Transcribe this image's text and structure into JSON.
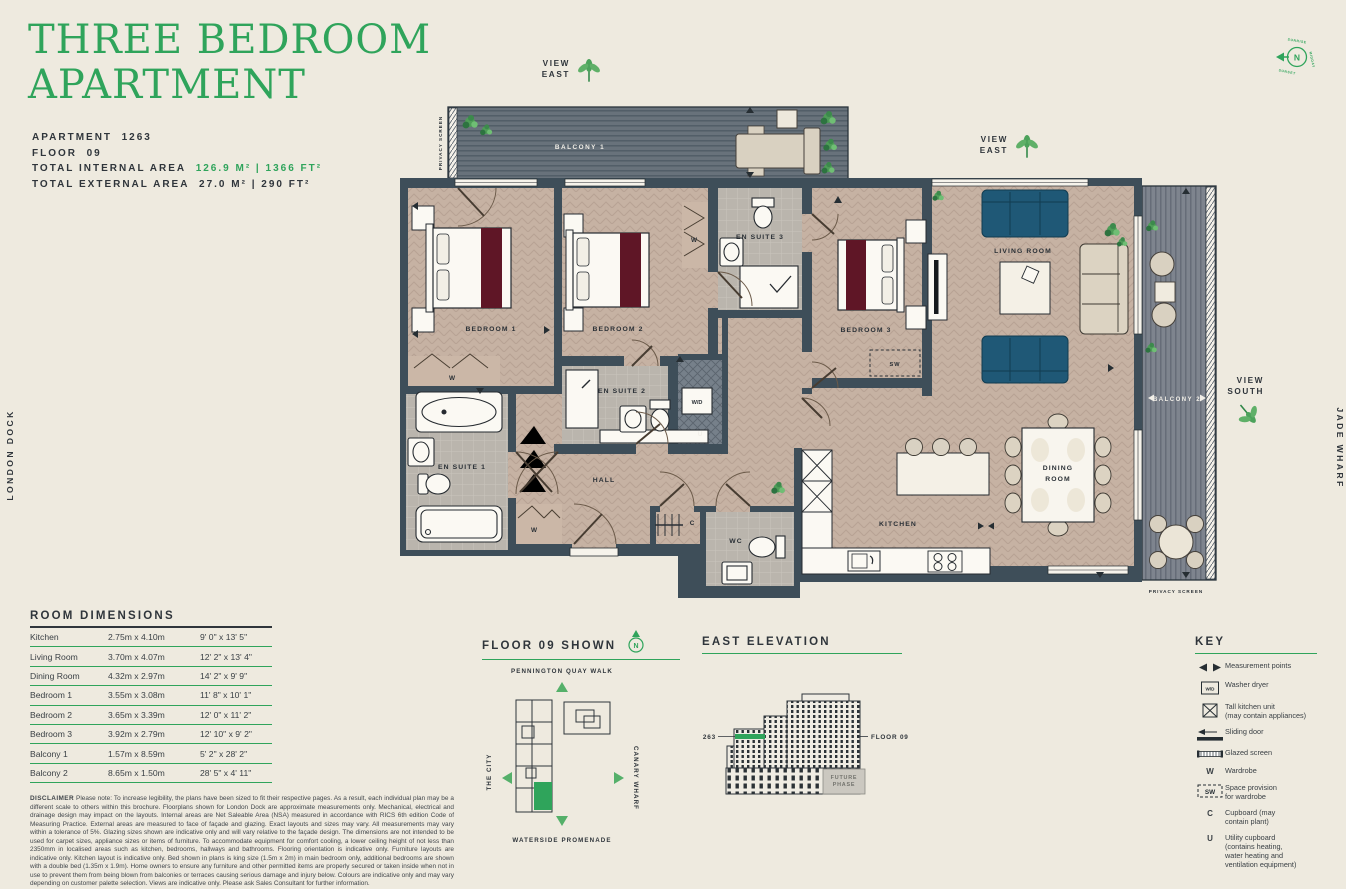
{
  "header": {
    "title_line1": "THREE BEDROOM",
    "title_line2": "APARTMENT",
    "apartment_label": "APARTMENT",
    "apartment_value": "1263",
    "floor_label": "FLOOR",
    "floor_value": "09",
    "internal_label": "TOTAL INTERNAL AREA",
    "internal_value": "126.9 M² | 1366 FT²",
    "external_label": "TOTAL EXTERNAL AREA",
    "external_value": "27.0 M² | 290 FT²"
  },
  "plan": {
    "balcony1": "BALCONY 1",
    "balcony2": "BALCONY 2",
    "privacy_screen": "PRIVACY SCREEN",
    "rooms": {
      "bedroom1": "BEDROOM 1",
      "bedroom2": "BEDROOM 2",
      "bedroom3": "BEDROOM 3",
      "ensuite1": "EN SUITE 1",
      "ensuite2": "EN SUITE 2",
      "ensuite3": "EN SUITE 3",
      "hall": "HALL",
      "wc": "WC",
      "kitchen": "KITCHEN",
      "dining": [
        "DINING",
        "ROOM"
      ],
      "living": "LIVING ROOM"
    },
    "markers": {
      "wardrobe": "W",
      "space_wardrobe": "SW",
      "washer_dryer": "W/D",
      "utility": "U",
      "cupboard": "C"
    },
    "view_east": [
      "VIEW",
      "EAST"
    ],
    "view_south": [
      "VIEW",
      "SOUTH"
    ],
    "compass": {
      "north": "N",
      "sunrise": "SUNRISE",
      "midday": "MIDDAY",
      "sunset": "SUNSET"
    },
    "london_dock": "LONDON DOCK",
    "jade_wharf": "JADE WHARF"
  },
  "dimensions": {
    "heading": "ROOM DIMENSIONS",
    "rows": [
      {
        "room": "Kitchen",
        "metric": "2.75m x 4.10m",
        "imperial": "9' 0\" x 13' 5\""
      },
      {
        "room": "Living Room",
        "metric": "3.70m x 4.07m",
        "imperial": "12' 2\" x 13' 4\""
      },
      {
        "room": "Dining Room",
        "metric": "4.32m x 2.97m",
        "imperial": "14' 2\" x 9' 9\""
      },
      {
        "room": "Bedroom 1",
        "metric": "3.55m x 3.08m",
        "imperial": "11' 8\" x 10' 1\""
      },
      {
        "room": "Bedroom 2",
        "metric": "3.65m x 3.39m",
        "imperial": "12' 0\" x 11' 2\""
      },
      {
        "room": "Bedroom 3",
        "metric": "3.92m x 2.79m",
        "imperial": "12' 10\" x 9' 2\""
      },
      {
        "room": "Balcony 1",
        "metric": "1.57m x 8.59m",
        "imperial": "5' 2\" x 28' 2\""
      },
      {
        "room": "Balcony 2",
        "metric": "8.65m x 1.50m",
        "imperial": "28' 5\" x 4' 11\""
      }
    ]
  },
  "disclaimer": {
    "label": "DISCLAIMER",
    "body": "Please note: To increase legibility, the plans have been sized to fit their respective pages. As a result, each individual plan may be a different scale to others within this brochure. Floorplans shown for London Dock are approximate measurements only. Mechanical, electrical and drainage design may impact on the layouts. Internal areas are Net Saleable Area (NSA) measured in accordance with RICS 6th edition Code of Measuring Practice. External areas are measured to face of façade and glazing. Exact layouts and sizes may vary. All measurements may vary within a tolerance of 5%. Glazing sizes shown are indicative only and will vary relative to the façade design. The dimensions are not intended to be used for carpet sizes, appliance sizes or items of furniture. To accommodate equipment for comfort cooling, a lower ceiling height of not less than 2350mm in localised areas such as kitchen, bedrooms, hallways and bathrooms. Flooring orientation is indicative only. Furniture layouts are indicative only. Kitchen layout is indicative only. Bed shown in plans is king size (1.5m x 2m) in main bedroom only, additional bedrooms are shown with a double bed (1.35m x 1.9m). Home owners to ensure any furniture and other permitted items are properly secured or taken inside when not in use to prevent them from being blown from balconies or terraces causing serious damage and injury below. Colours are indicative only and may vary depending on customer palette selection. Views are indicative only. Please ask Sales Consultant for further information."
  },
  "floor_shown": {
    "heading": "FLOOR 09 SHOWN",
    "north": "N",
    "street_top": "PENNINGTON QUAY WALK",
    "street_left": "THE CITY",
    "street_right": "CANARY WHARF",
    "street_bottom": "WATERSIDE PROMENADE"
  },
  "elevation": {
    "heading": "EAST ELEVATION",
    "apartment_label": "1263",
    "floor_label": "FLOOR 09",
    "future_phase": "FUTURE\nPHASE"
  },
  "key": {
    "heading": "KEY",
    "items": [
      {
        "label": "Measurement points"
      },
      {
        "label": "Washer dryer"
      },
      {
        "label": "Tall kitchen unit\n(may contain appliances)"
      },
      {
        "label": "Sliding door"
      },
      {
        "label": "Glazed screen"
      },
      {
        "label": "Wardrobe"
      },
      {
        "label": "Space provision\nfor wardrobe"
      },
      {
        "label": "Cupboard (may\ncontain plant)"
      },
      {
        "label": "Utility cupboard\n(contains heating,\nwater heating and\nventilation equipment)"
      }
    ]
  }
}
